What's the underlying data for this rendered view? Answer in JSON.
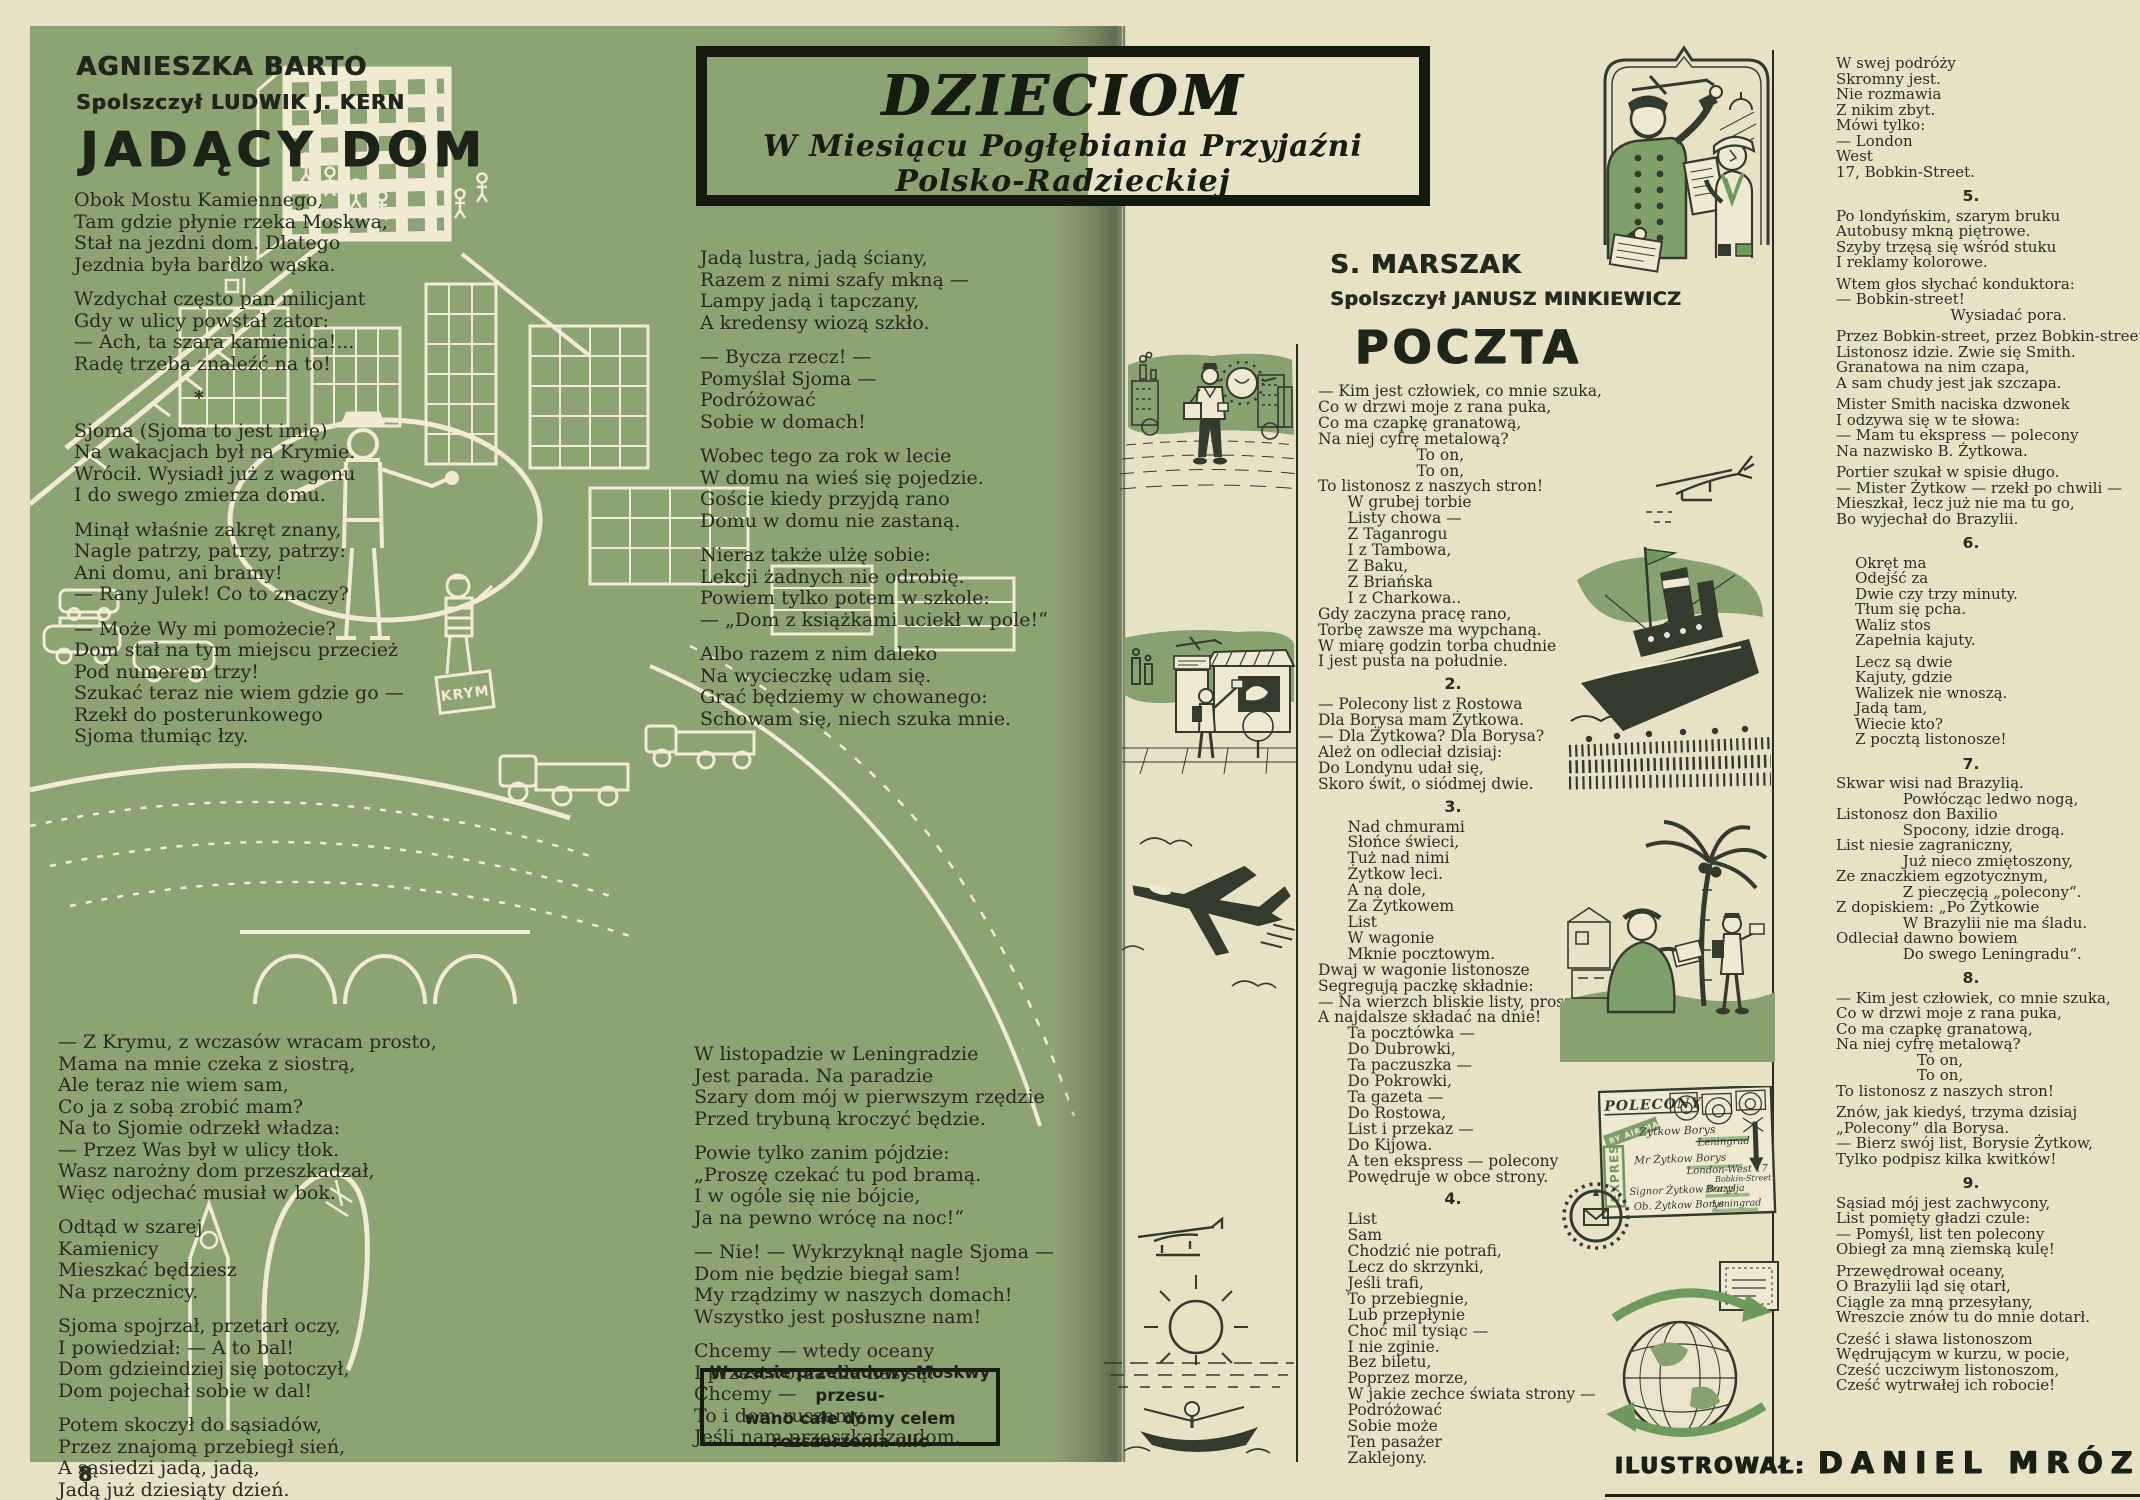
{
  "left_page": {
    "author": "AGNIESZKA BARTO",
    "translator": "Spolszczył LUDWIK J. KERN",
    "title": "JADĄCY DOM",
    "col1a": [
      {
        "lines": [
          "Obok Mostu Kamiennego,",
          "Tam gdzie płynie rzeka Moskwa,",
          "Stał na jezdni dom. Dlatego",
          "Jezdnia była bardzo wąska."
        ]
      },
      {
        "lines": [
          "Wzdychał często pan milicjant",
          "Gdy w ulicy powstał zator:",
          "— Ach, ta szara kamienica!...",
          "Radę trzeba znaleźć na to!"
        ]
      },
      {
        "sep": "*"
      },
      {
        "lines": [
          "Sjoma (Sjoma to jest imię)",
          "Na wakacjach był na Krymie.",
          "Wrócił. Wysiadł już z wagonu",
          "I do swego zmierza domu."
        ]
      },
      {
        "lines": [
          "Minął właśnie zakręt znany,",
          "Nagle patrzy, patrzy, patrzy:",
          "Ani domu, ani bramy!",
          "— Rany Julek! Co to znaczy?"
        ]
      },
      {
        "lines": [
          "— Może Wy mi pomożecie?",
          "Dom stał na tym miejscu przecież",
          "Pod numerem trzy!",
          "Szukać teraz nie wiem gdzie go —",
          "Rzekł do posterunkowego",
          "Sjoma tłumiąc łzy."
        ]
      }
    ],
    "col1b": [
      {
        "lines": [
          "— Z Krymu, z wczasów wracam prosto,",
          "Mama na mnie czeka z siostrą,",
          "Ale teraz nie wiem sam,",
          "Co ja z sobą zrobić mam?",
          "Na to Sjomie odrzekł władza:",
          "— Przez Was był w ulicy tłok.",
          "Wasz narożny dom przeszkadzał,",
          "Więc odjechać musiał w bok."
        ]
      },
      {
        "lines": [
          "Odtąd w szarej",
          "Kamienicy",
          "Mieszkać będziesz",
          "Na przecznicy."
        ]
      },
      {
        "lines": [
          "Sjoma spojrzał, przetarł oczy,",
          "I powiedział: — A to bal!",
          "Dom gdzieindziej się potoczył,",
          "Dom pojechał sobie w dal!"
        ]
      },
      {
        "lines": [
          "Potem skoczył do sąsiadów,",
          "Przez znajomą przebiegł sień,",
          "A sąsiedzi jadą, jadą,",
          "Jadą już dziesiąty dzień."
        ]
      }
    ],
    "col2a": [
      {
        "lines": [
          "Jadą lustra, jadą ściany,",
          "Razem z nimi szafy mkną —",
          "Lampy jadą i tapczany,",
          "A kredensy wiozą szkło."
        ]
      },
      {
        "lines": [
          "— Bycza rzecz! —",
          "Pomyślał Sjoma —",
          "Podróżować",
          "Sobie w domach!"
        ]
      },
      {
        "lines": [
          "Wobec tego za rok w lecie",
          "W domu na wieś się pojedzie.",
          "Goście kiedy przyjdą rano",
          "Domu w domu nie zastaną."
        ]
      },
      {
        "lines": [
          "Nieraz także ulżę sobie:",
          "Lekcji żadnych nie odrobię.",
          "Powiem tylko potem w szkole:",
          "— „Dom z książkami uciekł w pole!“"
        ]
      },
      {
        "lines": [
          "Albo razem z nim daleko",
          "Na wycieczkę udam się.",
          "Grać będziemy w chowanego:",
          "Schowam się, niech szuka mnie."
        ]
      }
    ],
    "col2b": [
      {
        "lines": [
          "W listopadzie w Leningradzie",
          "Jest parada. Na paradzie",
          "Szary dom mój w pierwszym rzędzie",
          "Przed trybuną kroczyć będzie."
        ]
      },
      {
        "lines": [
          "Powie tylko zanim pójdzie:",
          "„Proszę czekać tu pod bramą.",
          "I w ogóle się nie bójcie,",
          "Ja na pewno wrócę na noc!“"
        ]
      },
      {
        "lines": [
          "— Nie! — Wykrzyknął nagle Sjoma —",
          "Dom nie będzie biegał sam!",
          "My rządzimy w naszych domach!",
          "Wszystko jest posłuszne nam!"
        ]
      },
      {
        "lines": [
          "Chcemy — wtedy oceany",
          "I przestworza dla nas są!",
          "Chcemy —",
          "To i dom ruszamy,",
          "Jeśli nam przeszkadza dom."
        ]
      }
    ],
    "footnote_line1": "W czasie przebudowy Moskwy przesu-",
    "footnote_line2": "wano całe domy celem rozszerzenia ulic",
    "suitcase_label": "KRYM",
    "page_number": "8"
  },
  "banner": {
    "title": "DZIECIOM",
    "sub1": "W Miesiącu Pogłębiania Przyjaźni",
    "sub2": "Polsko-Radzieckiej"
  },
  "right_page": {
    "author": "S. MARSZAK",
    "translator": "Spolszczył JANUSZ MINKIEWICZ",
    "title": "POCZTA",
    "poczta_col": [
      {
        "lines": [
          "— Kim jest człowiek, co mnie szuka,",
          "Co w drzwi moje z rana puka,",
          "Co ma czapkę granatową,",
          "Na niej cyfrę metalową?",
          "                    To on,",
          "                    To on,",
          "To listonosz z naszych stron!",
          "      W grubej torbie",
          "      Listy chowa —",
          "      Z Taganrogu",
          "      I z Tambowa,",
          "      Z Baku,",
          "      Z Briańska",
          "      I z Charkowa..",
          "Gdy zaczyna pracę rano,",
          "Torbę zawsze ma wypchaną.",
          "W miarę godzin torba chudnie",
          "I jest pusta na południe."
        ]
      },
      {
        "num": "2.",
        "lines": [
          "— Polecony list z Rostowa",
          "Dla Borysa mam Żytkowa.",
          "— Dla Żytkowa? Dla Borysa?",
          "Ależ on odleciał dzisiaj:",
          "Do Londynu udał się,",
          "Skoro świt, o siódmej dwie."
        ]
      },
      {
        "num": "3.",
        "lines": [
          "      Nad chmurami",
          "      Słońce świeci,",
          "      Tuż nad nimi",
          "      Żytkow leci.",
          "      A na dole,",
          "      Za Żytkowem",
          "      List",
          "      W wagonie",
          "      Mknie pocztowym.",
          "Dwaj w wagonie listonosze",
          "Segregują paczkę składnie:",
          "— Na wierzch bliskie listy, proszę,",
          "A najdalsze składać na dnie!",
          "      Ta pocztówka —",
          "      Do Dubrowki,",
          "      Ta paczuszka —",
          "      Do Pokrowki,",
          "      Ta gazeta —",
          "      Do Rostowa,",
          "      List i przekaz —",
          "      Do Kijowa.",
          "      A ten ekspress — polecony",
          "      Powędruje w obce strony."
        ]
      },
      {
        "num": "4.",
        "lines": [
          "      List",
          "      Sam",
          "      Chodzić nie potrafi,",
          "      Lecz do skrzynki,",
          "      Jeśli trafi,",
          "      To przebiegnie,",
          "      Lub przepłynie",
          "      Choć mil tysiąc —",
          "      I nie zginie.",
          "      Bez biletu,",
          "      Poprzez morze,",
          "      W jakie zechce świata strony —",
          "      Podróżować",
          "      Sobie może",
          "      Ten pasażer",
          "      Zaklejony."
        ]
      }
    ],
    "right_col": [
      {
        "lines": [
          "W swej podróży",
          "Skromny jest.",
          "Nie rozmawia",
          "Z nikim zbyt.",
          "Mówi tylko:",
          "— London",
          "West",
          "17, Bobkin-Street."
        ]
      },
      {
        "num": "5.",
        "lines": [
          "Po londyńskim, szarym bruku",
          "Autobusy mkną piętrowe.",
          "Szyby trzęsą się wśród stuku",
          "I reklamy kolorowe.",
          "",
          "Wtem głos słychać konduktora:",
          "— Bobkin-street!",
          "                        Wysiadać pora.",
          "",
          "Przez Bobkin-street, przez Bobkin-street",
          "Listonosz idzie. Zwie się Smith.",
          "Granatowa na nim czapa,",
          "A sam chudy jest jak szczapa.",
          "",
          "Mister Smith naciska dzwonek",
          "I odzywa się w te słowa:",
          "— Mam tu ekspress — polecony",
          "Na nazwisko B. Żytkowa.",
          "",
          "Portier szukał w spisie długo.",
          "— Mister Żytkow — rzekł po chwili —",
          "Mieszkał, lecz już nie ma tu go,",
          "Bo wyjechał do Brazylii."
        ]
      },
      {
        "num": "6.",
        "lines": [
          "    Okręt ma",
          "    Odejść za",
          "    Dwie czy trzy minuty.",
          "    Tłum się pcha.",
          "    Waliz stos",
          "    Zapełnia kajuty.",
          "",
          "    Lecz są dwie",
          "    Kajuty, gdzie",
          "    Walizek nie wnoszą.",
          "    Jadą tam,",
          "    Wiecie kto?",
          "    Z pocztą listonosze!"
        ]
      },
      {
        "num": "7.",
        "lines": [
          "Skwar wisi nad Brazylią.",
          "              Powłócząc ledwo nogą,",
          "Listonosz don Baxilio",
          "              Spocony, idzie drogą.",
          "List niesie zagraniczny,",
          "              Już nieco zmiętoszony,",
          "Ze znaczkiem egzotycznym,",
          "              Z pieczęcią „polecony“.",
          "Z dopiskiem: „Po Żytkowie",
          "              W Brazylii nie ma śladu.",
          "Odleciał dawno bowiem",
          "              Do swego Leningradu“."
        ]
      },
      {
        "num": "8.",
        "lines": [
          "— Kim jest człowiek, co mnie szuka,",
          "Co w drzwi moje z rana puka,",
          "Co ma czapkę granatową,",
          "Na niej cyfrę metalową?",
          "                 To on,",
          "                 To on,",
          "To listonosz z naszych stron!",
          "",
          "Znów, jak kiedyś, trzyma dzisiaj",
          "„Polecony“ dla Borysa.",
          "— Bierz swój list, Borysie Żytkow,",
          "Tylko podpisz kilka kwitków!"
        ]
      },
      {
        "num": "9.",
        "lines": [
          "Sąsiad mój jest zachwycony,",
          "List pomięty gładzi czule:",
          "— Pomyśl, list ten polecony",
          "Obiegł za mną ziemską kulę!",
          "",
          "Przewędrował oceany,",
          "O Brazylii ląd się otarł,",
          "Ciągle za mną przesyłany,",
          "Wreszcie znów tu do mnie dotarł.",
          "",
          "Cześć i sława listonoszom",
          "Wędrującym w kurzu, w pocie,",
          "Cześć uczciwym listonoszom,",
          "Cześć wytrwałej ich robocie!"
        ]
      }
    ],
    "credit_label": "ILUSTROWAŁ:",
    "credit_name": "DANIEL MRÓZ"
  },
  "envelope": {
    "registered": "POLECONY",
    "express": "EXPRES",
    "airmail": "BY AIR MAIL",
    "addr1": "Żytkow Borys",
    "addr1_place": "Leningrad",
    "addr2": "Mr Żytkow Borys",
    "addr2_place": "London-West 17",
    "addr2_street": "Bobkin-Street",
    "addr3": "Signor Żytkow Borys",
    "addr3_place": "Brazylja",
    "addr4": "Ob. Żytkow Borys",
    "addr4_place": "Leningrad"
  },
  "colors": {
    "page_green": "#8ea374",
    "paper_cream": "#e7e2c6",
    "ink": "#262b1f",
    "line_cream": "#f0ebd2",
    "accent_green": "#6f9a5e"
  }
}
